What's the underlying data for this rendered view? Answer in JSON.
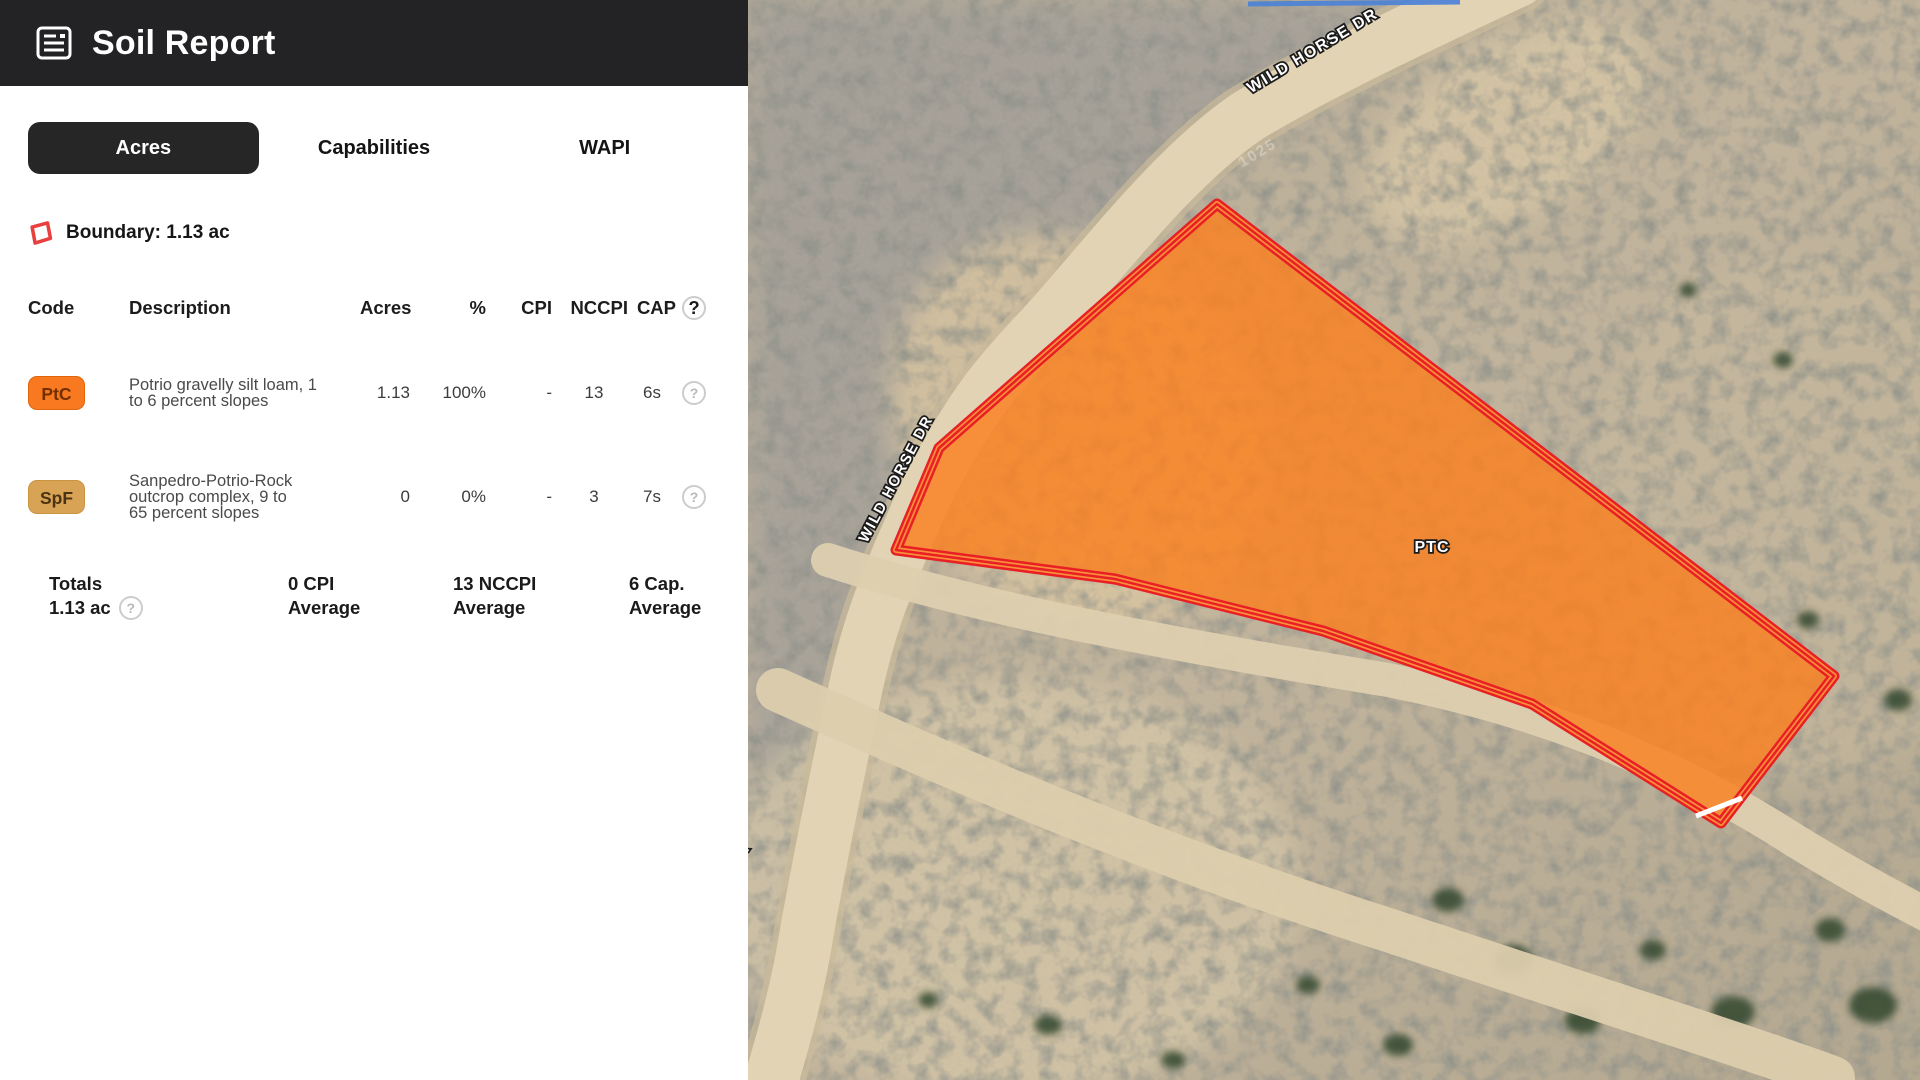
{
  "header": {
    "title": "Soil Report"
  },
  "tabs": {
    "acres": "Acres",
    "capabilities": "Capabilities",
    "wapi": "WAPI",
    "active_tab": "Acres"
  },
  "boundary": {
    "label": "Boundary: 1.13 ac",
    "icon_color": "#E8403F"
  },
  "soil_table": {
    "columns": {
      "code": "Code",
      "description": "Description",
      "acres": "Acres",
      "percent": "%",
      "cpi": "CPI",
      "nccpi": "NCCPI",
      "cap": "CAP"
    },
    "help_glyph": "?",
    "rows": [
      {
        "code": "PtC",
        "badge_bg": "#F8791F",
        "badge_text_color": "#732F00",
        "description": "Potrio gravelly silt loam, 1 to 6 percent slopes",
        "acres": "1.13",
        "percent": "100%",
        "cpi": "-",
        "nccpi": "13",
        "cap": "6s"
      },
      {
        "code": "SpF",
        "badge_bg": "#D8A355",
        "badge_text_color": "#4A3312",
        "description": "Sanpedro-Potrio-Rock outcrop complex, 9 to 65 percent slopes",
        "acres": "0",
        "percent": "0%",
        "cpi": "-",
        "nccpi": "3",
        "cap": "7s"
      }
    ],
    "totals": {
      "label": "Totals",
      "acres": "1.13 ac",
      "cpi_average": "0 CPI Average",
      "nccpi_average": "13 NCCPI Average",
      "cap_average": "6 Cap. Average"
    }
  },
  "map": {
    "road_labels": {
      "top": "WILD HORSE DR",
      "left": "WILD HORSE DR",
      "bottom_partial": "WILD HORSE DR"
    },
    "address_label": "1025",
    "parcel": {
      "label": "PTC",
      "fill": "#F87D1E",
      "border": "#E81F25"
    }
  }
}
